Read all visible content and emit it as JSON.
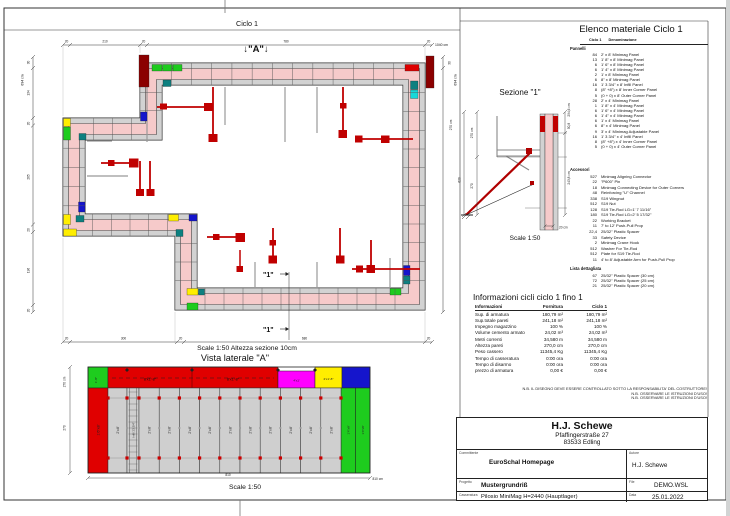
{
  "plan": {
    "title": "Ciclo 1",
    "marker_a": "↓\"A\"↓",
    "marker_1": "\"1\"",
    "scale_note": "Scale 1:50   Altezza sezione 10cm",
    "dims": {
      "top": [
        "20",
        "210",
        "20",
        "780",
        "20"
      ],
      "top_total": "1040 cm",
      "left": [
        "30",
        "134",
        "20",
        "265",
        "20",
        "196",
        "20"
      ],
      "left_total": "694 cm",
      "right_30": "30",
      "right_total": "694 cm",
      "right_height": "270 cm",
      "bottom": [
        "20",
        "300",
        "20",
        "680",
        "20"
      ]
    }
  },
  "sezione": {
    "title": "Sezione \"1\"",
    "scale": "Scale 1:50",
    "dims": {
      "left_top": "270 cm",
      "left_mid": "270",
      "left_total": "620",
      "right_total": "294,6 cm",
      "right_top": "50,8",
      "right_mid": "243,8 cm",
      "bottom": "20 cm"
    }
  },
  "vista": {
    "title": "Vista laterale \"A\"",
    "scale": "Scale 1:50",
    "dims": {
      "left_top": "270 cm",
      "left_mid": "270",
      "bottom": "810",
      "bottom_total": "810 cm"
    },
    "labels": {
      "corner_tl": "1'-8\"",
      "left_col": "1'6\"x8'",
      "top_band": "8'x1'-8\"",
      "magenta": "4'x1'",
      "yellow": "2'x1'-8\"",
      "gray": "2'x8'",
      "infill": "Infill 1'3 3/4\"",
      "right_col": "1'4\"x8'"
    }
  },
  "elenco": {
    "title": "Elenco materiale  Ciclo 1",
    "col_qty": "Ciclo 1",
    "col_name": "Denominazione",
    "pannelli_label": "Pannelli",
    "accessori_label": "Accessori",
    "lista_label": "Lista dettagliata",
    "pannelli": [
      {
        "qty": "84",
        "name": "2' x 8' Minimag Panel"
      },
      {
        "qty": "13",
        "name": "1' 8\" x 8' Minimag Panel"
      },
      {
        "qty": "6",
        "name": "1' 6\" x 8' Minimag Panel"
      },
      {
        "qty": "6",
        "name": "1' 4\" x 8' Minimag Panel"
      },
      {
        "qty": "2",
        "name": "1' x 8' Minimag Panel"
      },
      {
        "qty": "6",
        "name": "8\" x 8' Minimag Panel"
      },
      {
        "qty": "16",
        "name": "1' 3 3/4\" x 8' Infill Panel"
      },
      {
        "qty": "8",
        "name": "(8\" +8\") x 8' Inner Corner Panel"
      },
      {
        "qty": "5",
        "name": "(0 + 0) x 8' Outer Corner Panel"
      },
      {
        "qty": "28",
        "name": "2' x 4' Minimag Panel"
      },
      {
        "qty": "1",
        "name": "1' 8\" x 4' Minimag Panel"
      },
      {
        "qty": "6",
        "name": "1' 6\" x 4' Minimag Panel"
      },
      {
        "qty": "6",
        "name": "1' 4\" x 4' Minimag Panel"
      },
      {
        "qty": "6",
        "name": "1' x 4' Minimag Panel"
      },
      {
        "qty": "6",
        "name": "8\" x 4' Minimag Panel"
      },
      {
        "qty": "9",
        "name": "3' x 4' Minimag Adjustable Panel"
      },
      {
        "qty": "16",
        "name": "1' 3 3/4\" x 4' Infill Panel"
      },
      {
        "qty": "8",
        "name": "(8\" +8\") x 4' Inner Corner Panel"
      },
      {
        "qty": "5",
        "name": "(0 + 0) x 4' Outer Corner Panel"
      }
    ],
    "accessori": [
      {
        "qty": "527",
        "name": "Minimag Aligning Connector"
      },
      {
        "qty": "22",
        "name": "\"P600\" Pin"
      },
      {
        "qty": "18",
        "name": "Minimag Connecting Device for Outer Corners"
      },
      {
        "qty": "48",
        "name": "Reinforcing \"U\" Channel"
      },
      {
        "qty": "338",
        "name": "S19 Wingnut"
      },
      {
        "qty": "512",
        "name": "S19 Nut"
      },
      {
        "qty": "128",
        "name": "S19 Tie-Rod LG=1' 7 11/16\""
      },
      {
        "qty": "180",
        "name": "S19 Tie-Rod LG=2' 5 17/32\""
      },
      {
        "qty": "22",
        "name": "Working Bracket"
      },
      {
        "qty": "11",
        "name": "7' to 12' Push-Pull Prop"
      },
      {
        "qty": "22,4",
        "name": "25/32\" Plastic Spacer"
      },
      {
        "qty": "33",
        "name": "Safety Device"
      },
      {
        "qty": "2",
        "name": "Minimag Crane Hook"
      },
      {
        "qty": "512",
        "name": "Washer For Tie-Rod"
      },
      {
        "qty": "512",
        "name": "Plate for S19 Tie-Rod"
      },
      {
        "qty": "11",
        "name": "4' to 8' Adjustable Arm for Push-Pull Prop"
      }
    ],
    "lista": [
      {
        "qty": "67",
        "name": "25/32\" Plastic Spacer (30 cm)"
      },
      {
        "qty": "72",
        "name": "25/32\" Plastic Spacer (25 cm)"
      },
      {
        "qty": "21",
        "name": "25/32\" Plastic Spacer (20 cm)"
      }
    ]
  },
  "info": {
    "title": "Informazioni cicli  ciclo 1 fino 1",
    "headers": [
      "Informazioni",
      "Fornitura",
      "Ciclo 1"
    ],
    "rows": [
      {
        "label": "Sup. di armatura",
        "fornitura": "180,79 m²",
        "ciclo": "180,79 m²"
      },
      {
        "label": "Sup.totale pareti",
        "fornitura": "241,18 m²",
        "ciclo": "241,18 m²"
      },
      {
        "label": "Impegno magazzino",
        "fornitura": "100 %",
        "ciclo": "100 %"
      },
      {
        "label": "Volume cemento armato",
        "fornitura": "24,02 m³",
        "ciclo": "24,02 m³"
      },
      {
        "label": "Metri correnti",
        "fornitura": "34,580 m",
        "ciclo": "34,580 m"
      },
      {
        "label": "Altezza pareti",
        "fornitura": "270,0 cm",
        "ciclo": "270,0 cm"
      },
      {
        "label": "Peso cassero",
        "fornitura": "11345,4 Kg",
        "ciclo": "11345,4 Kg"
      },
      {
        "label": "Tempo di casseratura",
        "fornitura": "0:00 ora",
        "ciclo": "0:00 ora"
      },
      {
        "label": "Tempo di disarmo",
        "fornitura": "0:00 ora",
        "ciclo": "0:00 ora"
      },
      {
        "label": "prezzo di armatura",
        "fornitura": "0,00 €",
        "ciclo": "0,00 €"
      }
    ]
  },
  "notes": [
    "N.B. IL DISEGNO DEVE ESSERE CONTROLLATO SOTTO LA RESPONSABILITA' DEL COSTRUTTORE!",
    "N.B. OSSERVARE LE ISTRUZIONI D'USO!",
    "N.B. OSSERVARE LE ISTRUZIONI D'USO!"
  ],
  "titleblock": {
    "company": "H.J. Schewe",
    "address1": "Pfaffingerstraße 27",
    "address2": "83533 Edling",
    "committente_label": "Committente",
    "committente": "EuroSchal Homepage",
    "autore_label": "Autore",
    "autore": "H.J. Schewe",
    "progetto_label": "Progetto",
    "progetto": "Mustergrundriß",
    "file_label": "File",
    "file": "DEMO.WSL",
    "casseratura_label": "Casseratura",
    "casseratura": "Pilosio MiniMag H=2440 (Hauptlager)",
    "data_label": "Data",
    "data": "25.01.2022"
  },
  "colors": {
    "wall_pink": "#f6caca",
    "panel_gray": "#d2d2d2",
    "prop_red": "#c00000",
    "corner_darkred": "#8b0000",
    "green": "#1ecc1e",
    "yellow": "#ffee00",
    "blue": "#1515cc",
    "teal": "#0d8080",
    "cyan": "#17d9d9",
    "magenta": "#ff00ff"
  }
}
